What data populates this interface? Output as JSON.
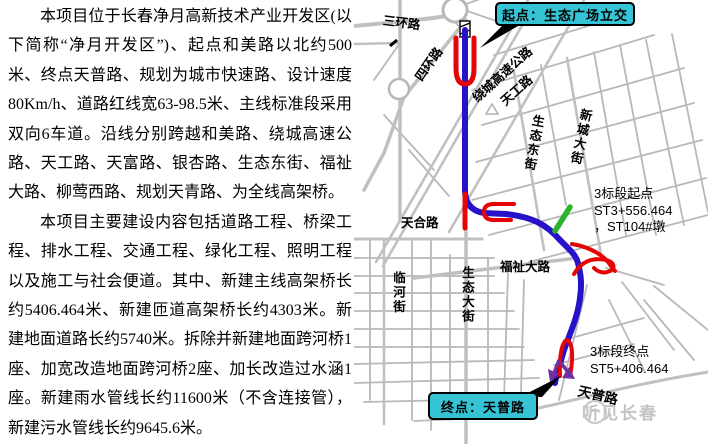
{
  "document": {
    "paragraph1": "本项目位于长春净月高新技术产业开发区(以下简称“净月开发区”)、起点和美路以北约500米、终点天普路、规划为城市快速路、设计速度80Km/h、道路红线宽63-98.5米、主线标准段采用双向6车道。沿线分别跨越和美路、绕城高速公路、天工路、天富路、银杏路、生态东街、福祉大路、柳莺西路、规划天青路、为全线高架桥。",
    "paragraph2": "本项目主要建设内容包括道路工程、桥梁工程、排水工程、交通工程、绿化工程、照明工程以及施工与社会便道。其中、新建主线高架桥长约5406.464米、新建匝道高架桥长约4303米。新建地面道路长约5740米。拆除并新建地面跨河桥1座、加宽改造地面跨河桥2座、加长改造过水涵1座。新建雨水管线长约11600米（不含连接管），新建污水管线长约9645.6米。"
  },
  "map": {
    "callouts": {
      "start": "起点：生态广场立交",
      "end": "终点：天普路"
    },
    "section_markers": {
      "start_line1": "3标段起点",
      "start_line2": "ST3+556.464",
      "start_line3": "，ST104#墩",
      "end_line1": "3标段终点",
      "end_line2": "ST5+406.464"
    },
    "road_labels": {
      "sanhuanlu": "三环路",
      "sihuanlu": "四环路",
      "raocheng_gaosu": "绕城高速公路",
      "tiangonglu": "天工路",
      "shengtai_dongjie": "生态东街",
      "xincheng_dajie": "新城大街",
      "tianhelu": "天合路",
      "linhejie": "临河街",
      "shengtai_dajie": "生态大街",
      "fuzhi_dalu": "福祉大路",
      "tianpulu": "天普路"
    },
    "watermark": "听见长春",
    "colors": {
      "route_blue": "#2612c9",
      "ramp_red": "#e60505",
      "marker_green": "#2db32d",
      "arrow_purple": "#7030a0",
      "callout_cyan": "#35c4d6",
      "road_gray": "#b8b8b8"
    }
  }
}
